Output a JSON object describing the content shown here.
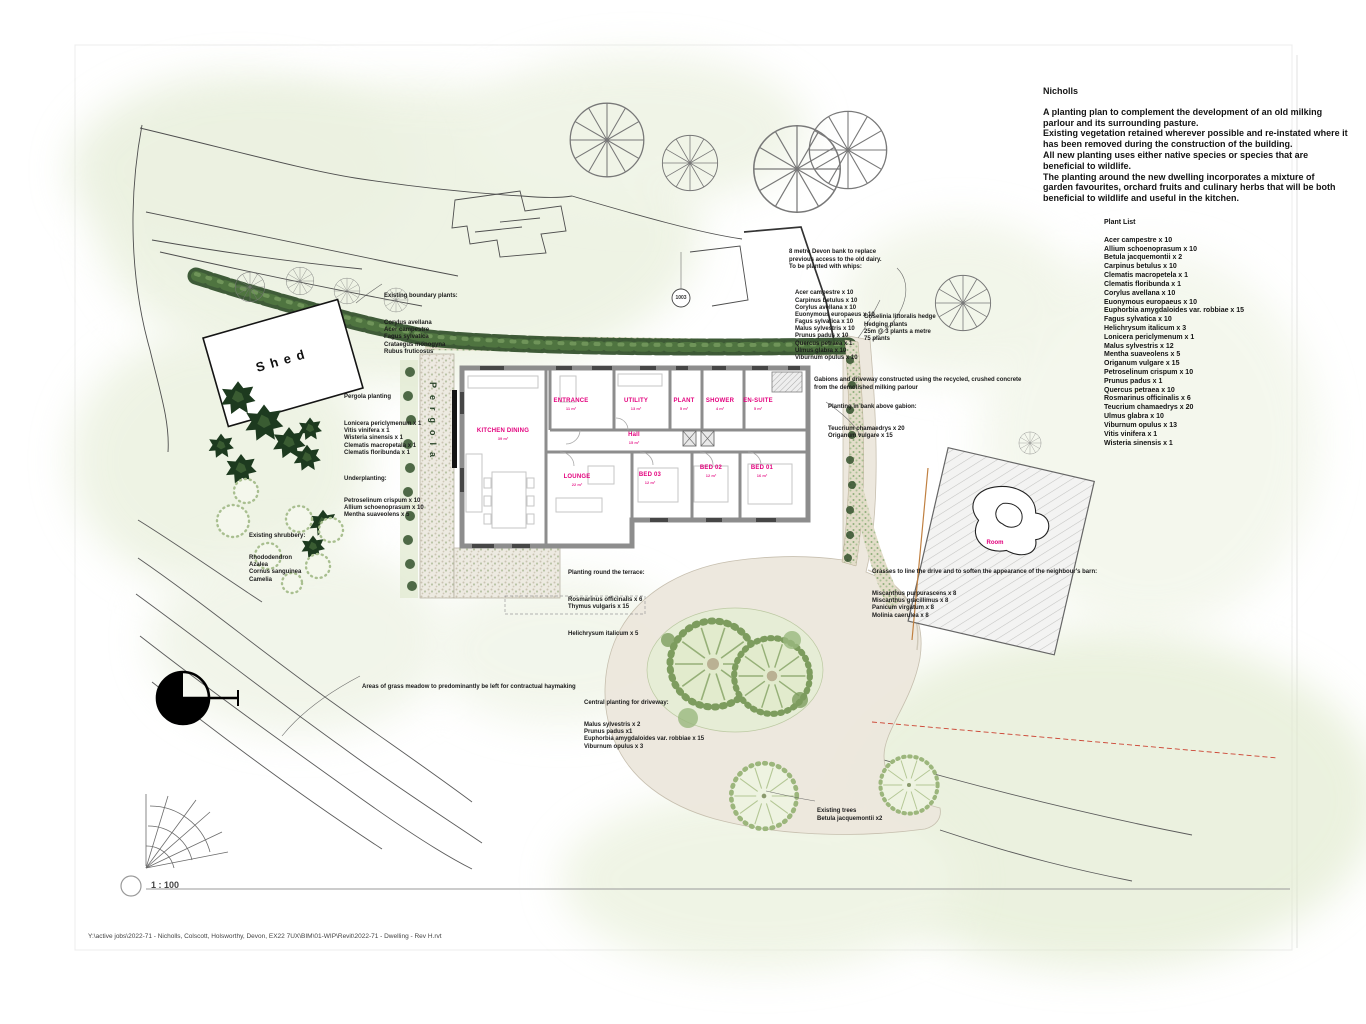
{
  "sheet": {
    "scale": "1 : 100",
    "tag_1003": "1003",
    "file_path": "Y:\\active jobs\\2022-71 - Nicholls, Colscott, Holsworthy, Devon, EX22 7UX\\BIM\\01-WIP\\Revit\\2022-71 - Dwelling - Rev H.rvt"
  },
  "title_block": {
    "client": "Nicholls",
    "lines": [
      "A planting plan to complement the development of an old milking",
      "parlour and its surrounding pasture.",
      "Existing vegetation retained wherever possible and re-instated where it",
      "has been removed during the construction of the building.",
      "All new planting uses either native species or species that are",
      "beneficial to wildlife.",
      "The planting around the new dwelling incorporates a mixture of",
      "garden favourites, orchard fruits and culinary herbs that will be both",
      "beneficial to wildlife and useful in the kitchen."
    ]
  },
  "plant_list": {
    "heading": "Plant List",
    "items": [
      "Acer campestre x 10",
      "Allium schoenoprasum x 10",
      "Betula jacquemontii x 2",
      "Carpinus betulus x 10",
      "Clematis macropetela x 1",
      "Clematis floribunda x 1",
      "Corylus avellana x 10",
      "Euonymous europaeus x 10",
      "Euphorbia amygdaloides var. robbiae x 15",
      "Fagus sylvatica x 10",
      "Helichrysum italicum x 3",
      "Lonicera periclymenum x 1",
      "Malus sylvestris x 12",
      "Mentha suaveolens x 5",
      "Origanum vulgare x 15",
      "Petroselinum crispum x 10",
      "Prunus padus x 1",
      "Quercus petraea x 10",
      "Rosmarinus officinalis x 6",
      "Teucrium chamaedrys x 20",
      "Ulmus glabra x 10",
      "Viburnum opulus x 13",
      "Vitis vinifera x 1",
      "Wisteria sinensis x 1"
    ]
  },
  "notes": {
    "devon_bank": {
      "lines": [
        "8 metre Devon bank to replace",
        "previous access to the old dairy.",
        "To be planted with whips:"
      ],
      "whips": [
        "Acer campestre x 10",
        "Carpinus betulus x 10",
        "Corylus avellana x 10",
        "Euonymous europaeus x 10",
        "Fagus sylvatica x 10",
        "Malus sylvestris x 10",
        "Prunus padus x 10",
        "Quercus petraea x 1",
        "Ulmus glabra x 10",
        "Viburnum opulus x 10"
      ]
    },
    "griselinia": {
      "lines": [
        "Griselinia littoralis hedge",
        "Hedging plants",
        "25m @ 3 plants a metre",
        "75 plants"
      ]
    },
    "gabions": {
      "lines": [
        "Gabions and driveway constructed using the recycled, crushed concrete",
        "from the demolished milking parlour"
      ]
    },
    "bank_above_gabion": {
      "heading": "Planting in bank above gabion:",
      "items": [
        "Teucrium chamaedrys x 20",
        "Origanum vulgare x 15"
      ]
    },
    "pergola": {
      "heading": "Pergola planting",
      "climbers": [
        "Lonicera periclymenum x 1",
        "Vitis vinifera x 1",
        "Wisteria sinensis x 1",
        "Clematis macropetala x 1",
        "Clematis floribunda x 1"
      ],
      "subheading": "Underplanting:",
      "underplanting": [
        "Petroselinum crispum x 10",
        "Allium schoenoprasum x 10",
        "Mentha suaveolens x 5"
      ]
    },
    "boundary": {
      "heading": "Existing boundary plants:",
      "items": [
        "Corylus avellana",
        "Acer campestre",
        "Fagus sylvatica",
        "Crataegus monogyna",
        "Rubus fruticosus"
      ]
    },
    "shrubbery": {
      "heading": "Existing shrubbery:",
      "items": [
        "Rhododendron",
        "Azalea",
        "Cornus sanguinea",
        "Camelia"
      ]
    },
    "terrace": {
      "heading": "Planting round the terrace:",
      "items": [
        "Rosmarinus officinalis x 6",
        "Thymus vulgaris x 15"
      ],
      "extra": [
        "Helichrysum italicum x 5"
      ]
    },
    "grasses": {
      "heading": "Grasses to line the drive and to soften the appearance of the neighbour's barn:",
      "items": [
        "Miscanthus purpurascens x 8",
        "Miscanthus gracillimus x 8",
        "Panicum virgatum x 8",
        "Molinia caerulea x 8"
      ]
    },
    "meadow": {
      "text": "Areas of grass meadow to predominantly be left for contractual haymaking"
    },
    "central": {
      "heading": "Central planting for driveway:",
      "items": [
        "Malus sylvestris x 2",
        "Prunus padus x1",
        "Euphorbia amygdaloides var. robbiae x 15",
        "Viburnum opulus x 3"
      ]
    },
    "existing_trees": {
      "lines": [
        "Existing trees",
        "Betula jacquemontii x2"
      ]
    }
  },
  "labels": {
    "shed": "Shed",
    "pergola": "Pergola",
    "barn_room": "Room"
  },
  "floor_plan": {
    "rooms": [
      {
        "label": "KITCHEN DINING",
        "area": "39 m²"
      },
      {
        "label": "ENTRANCE",
        "area": "11 m²"
      },
      {
        "label": "UTILITY",
        "area": "13 m²"
      },
      {
        "label": "PLANT",
        "area": "5 m²"
      },
      {
        "label": "SHOWER",
        "area": "4 m²"
      },
      {
        "label": "EN-SUITE",
        "area": "5 m²"
      },
      {
        "label": "Hall",
        "area": "15 m²"
      },
      {
        "label": "LOUNGE",
        "area": "22 m²"
      },
      {
        "label": "BED 03",
        "area": "12 m²"
      },
      {
        "label": "BED 02",
        "area": "12 m²"
      },
      {
        "label": "BED 01",
        "area": "16 m²"
      }
    ]
  },
  "colors": {
    "accent_magenta": "#e3007d",
    "wash_green": "#e3ecd2",
    "hedge_green": "#35522e",
    "drive_beige": "#ece7dd"
  }
}
